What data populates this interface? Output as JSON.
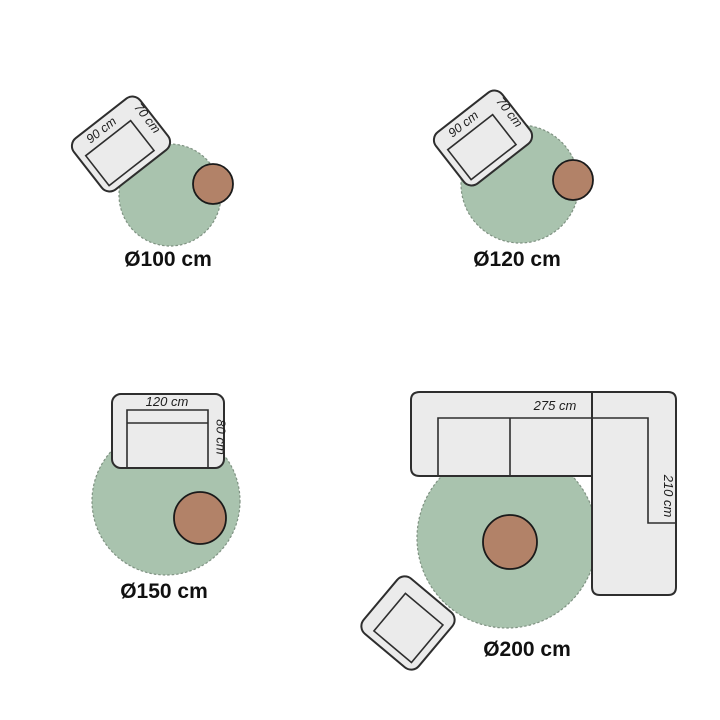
{
  "colors": {
    "background": "#ffffff",
    "rug_fill": "#a9c3ae",
    "rug_stroke": "#7f9282",
    "furniture_fill": "#ebebeb",
    "furniture_stroke": "#2e2e2e",
    "table_fill": "#b28268",
    "table_stroke": "#1a1a1a",
    "label_text": "#111111",
    "dim_text": "#1d1d1d"
  },
  "panels": {
    "rug_100": {
      "size_label": "Ø100 cm",
      "chair_width": "90 cm",
      "chair_depth": "70 cm"
    },
    "rug_120": {
      "size_label": "Ø120 cm",
      "chair_width": "90 cm",
      "chair_depth": "70 cm"
    },
    "rug_150": {
      "size_label": "Ø150 cm",
      "sofa_width": "120 cm",
      "sofa_depth": "80 cm"
    },
    "rug_200": {
      "size_label": "Ø200 cm",
      "sofa_width": "275 cm",
      "sofa_depth": "210 cm"
    }
  }
}
